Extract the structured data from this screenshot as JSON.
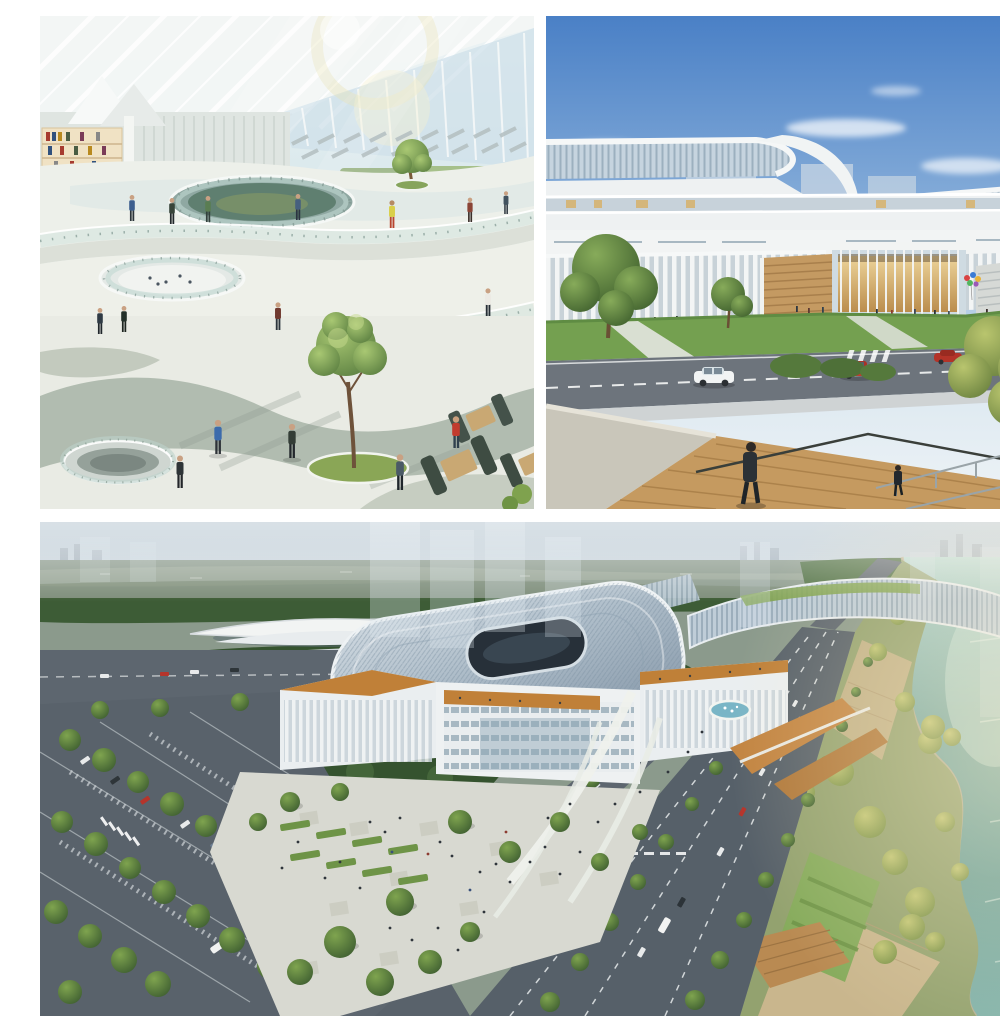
{
  "page": {
    "type": "image-collage",
    "subject": "Architectural renderings of a modern public cultural complex"
  },
  "collage": {
    "gutter_color": "#ffffff",
    "panels": [
      {
        "id": "atrium-interior",
        "position": "top-left",
        "label": "Interior atrium rendering: curved white mezzanine decks with glass railings, ribbed glass roof, indoor trees, library shelves, serpentine wood bench and cafe booths with visitors"
      },
      {
        "id": "street-elevation",
        "position": "top-right",
        "label": "Street-level rendering: long curved building with stacked white bands and glass louvers, warm-lit entrance pavilion, lawn, road with cars, and wooden terrace foreground with pedestrian"
      },
      {
        "id": "aerial-site",
        "position": "bottom",
        "label": "Aerial rendering: louvered-roof complex with central oval courtyard, plazas and fountain, tree-lined boulevard and parking, waterfront park and teal river with monorail station in forest"
      }
    ]
  },
  "palette": {
    "gutter": "#ffffff",
    "sky_blue": "#4a80c6",
    "sky_horizon": "#e3ecf2",
    "glass_louver": "#b9cad8",
    "facade_white": "#f2f4f3",
    "warm_interior": "#e0b874",
    "lawn_green": "#6f9d4e",
    "foliage_dark": "#35532f",
    "foliage_light": "#7fa45a",
    "foliage_warm": "#9cb964",
    "wood_deck": "#c2905a",
    "roof_orange": "#c08038",
    "asphalt": "#59626b",
    "paving_light": "#d8d9d1",
    "river_teal": "#78aaa4",
    "atrium_sage": "#aeb9ad",
    "booth_green": "#3e4c42",
    "accent_red": "#c23b2e"
  }
}
